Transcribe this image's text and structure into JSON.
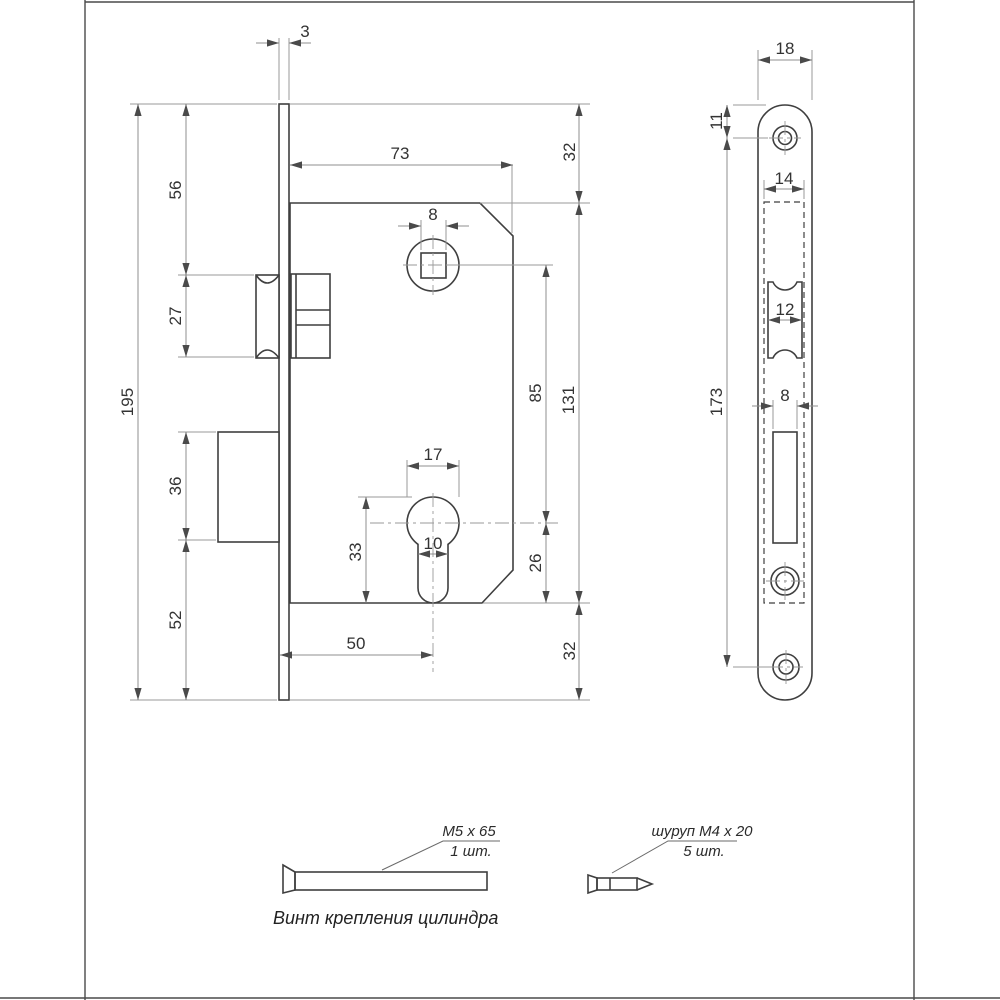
{
  "side_view": {
    "dims": {
      "plate_thickness": "3",
      "body_depth": "73",
      "offset_top": "32",
      "spindle_square": "8",
      "latch_top": "56",
      "latch_height": "27",
      "plate_height": "195",
      "bolt_height": "36",
      "bolt_bottom": "52",
      "spindle_to_cyl": "85",
      "body_height": "131",
      "cyl_diameter": "17",
      "cyl_slot": "10",
      "cyl_to_bottom": "33",
      "cyl_center_bottom": "26",
      "backset": "50",
      "offset_bottom": "32"
    }
  },
  "front_view": {
    "dims": {
      "plate_width": "18",
      "screw_top_offset": "11",
      "pocket_width": "14",
      "latch_width": "12",
      "screw_span": "173",
      "bolt_width": "8"
    }
  },
  "hardware": {
    "machine_screw": {
      "label": "M5 x 65",
      "qty": "1 шт."
    },
    "wood_screw": {
      "label": "шуруп M4 x 20",
      "qty": "5 шт."
    },
    "caption": "Винт крепления цилиндра"
  }
}
